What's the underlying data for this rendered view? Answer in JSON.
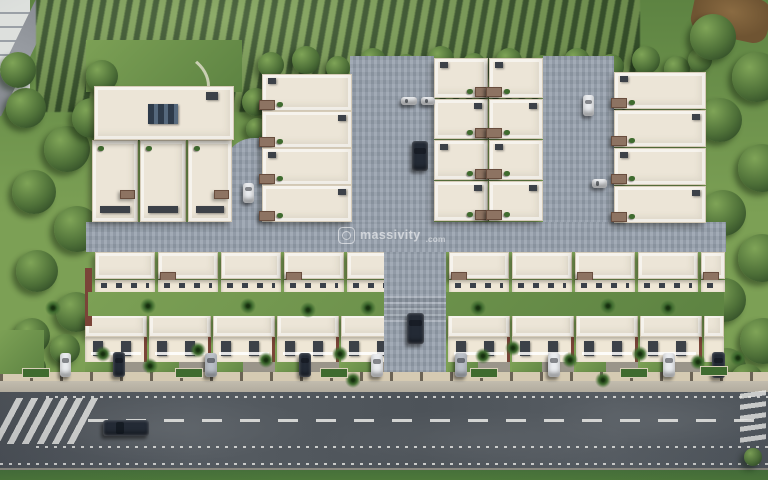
{
  "image": {
    "subject": "Aerial 3D rendering of a gated residential row-house township with orchard rows and trees behind, internal block-paved streets, terraced villas, parked cars, a boundary wall with planters, and a wide asphalt main road with zebra crossings in front"
  },
  "watermark": {
    "name": "massivity",
    "tld": ".com",
    "logo": "rounded-square-lens-icon"
  },
  "palette": {
    "lawn": "#7CA055",
    "lawnDark": "#5D8342",
    "orchardRow": "#3A572D",
    "treeLight": "#7FA457",
    "treeDark": "#2F4A26",
    "roof": "#ECE5D7",
    "roofEdge": "#D5CBB8",
    "facade": "#EFE7D6",
    "windowDark": "#3A4049",
    "pergola": "#8D7362",
    "maroon": "#7A4438",
    "paving": "#97A1AE",
    "asphalt": "#51565C",
    "sidewalk": "#B7B1A4",
    "wall": "#D5CAB2",
    "pillar": "#6B6355",
    "marking": "#E9E9E6",
    "carDark": "#232A35",
    "carWhite": "#E9EBEE",
    "carSilver": "#B9BEC6",
    "grassStrip": "#4E7A3A"
  }
}
